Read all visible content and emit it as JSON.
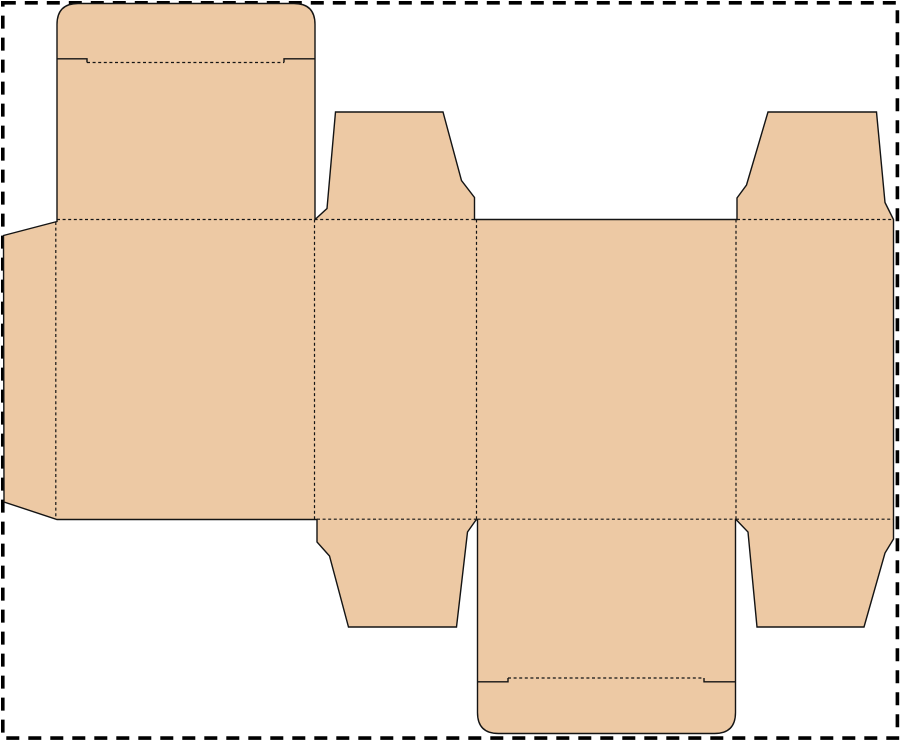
{
  "canvas": {
    "width": 900,
    "height": 741,
    "background_color": "#ffffff"
  },
  "page_border": {
    "name": "page-border-dashed",
    "color": "#000000",
    "stroke_width": 3.6,
    "dash": [
      13,
      9
    ],
    "x": 2.8,
    "y": 2.8,
    "width": 894.6,
    "height": 735.3
  },
  "dieline": {
    "material_fill_color": "#edc9a4",
    "cut_line_color": "#141414",
    "cut_line_width": 1.4,
    "fold_line_color": "#141414",
    "fold_line_width": 1.2,
    "fold_dash": [
      3,
      2.6
    ],
    "outline": {
      "name": "box-dieline-outline",
      "path": "M 78,3.5 L 294,3.5 Q 315,3.5 315,24.5 L 315,219.5 L 327,208.5 L 335.5,112 L 443,112 L 461.5,180.5 L 474.5,197.5 L 474.5,219.5 L 737,219.5 L 737,198 L 746.5,185 L 768,112 L 876.5,112 L 885,202.5 L 893.5,219.5 L 893.5,539 L 885,553 L 864,627 L 757,627 L 748,532 L 736,519.5 L 735.5,519.5 L 735.5,712.5 Q 735.5,733.5 714.5,733.5 L 498.5,733.5 Q 477.5,733.5 477.5,712.5 L 477.5,519.5 L 476,520 L 467.5,532 L 456.5,627 L 348.5,627 L 329.5,556 L 317,542 L 317,519.5 L 57,519.5 L 4,502 L 3.5,235.5 L 57,221.5 L 57,24.5 Q 57,3.5 78,3.5 Z"
    },
    "fold_lines": [
      {
        "name": "fold-glue-flap-vertical",
        "path": "M 55.8,222 L 55.8,519"
      },
      {
        "name": "fold-panel1-panel2-vertical",
        "path": "M 314.5,219.5 L 314.5,519"
      },
      {
        "name": "fold-panel2-panel3-vertical",
        "path": "M 476.5,219.5 L 476.5,519"
      },
      {
        "name": "fold-panel3-panel4-vertical",
        "path": "M 736,219.5 L 736,519"
      },
      {
        "name": "fold-top-row-left-horizontal",
        "path": "M 57,219.5 L 474.5,219.5"
      },
      {
        "name": "fold-top-row-right-horizontal",
        "path": "M 737,219.5 L 893.5,219.5"
      },
      {
        "name": "fold-bottom-row-flap2",
        "path": "M 317,519.2 L 476,519.2"
      },
      {
        "name": "fold-bottom-row-lid",
        "path": "M 477.5,519.2 L 735.5,519.2"
      },
      {
        "name": "fold-bottom-row-flap4",
        "path": "M 736,519.2 L 893.5,519.2"
      },
      {
        "name": "fold-top-lid-tuck",
        "path": "M 87,62.5 L 284,62.5"
      },
      {
        "name": "fold-bottom-lid-tuck",
        "path": "M 508,678 L 704,678"
      }
    ],
    "slit_lines": [
      {
        "name": "slit-top-lid-left",
        "path": "M 57,58.8 L 87,58.8 L 87,62.5"
      },
      {
        "name": "slit-top-lid-right",
        "path": "M 315,58.8 L 284,58.8 L 284,62.5"
      },
      {
        "name": "slit-bottom-lid-left",
        "path": "M 477.5,681.8 L 508,681.8 L 508,678"
      },
      {
        "name": "slit-bottom-lid-right",
        "path": "M 735.5,681.8 L 704,681.8 L 704,678"
      }
    ]
  }
}
